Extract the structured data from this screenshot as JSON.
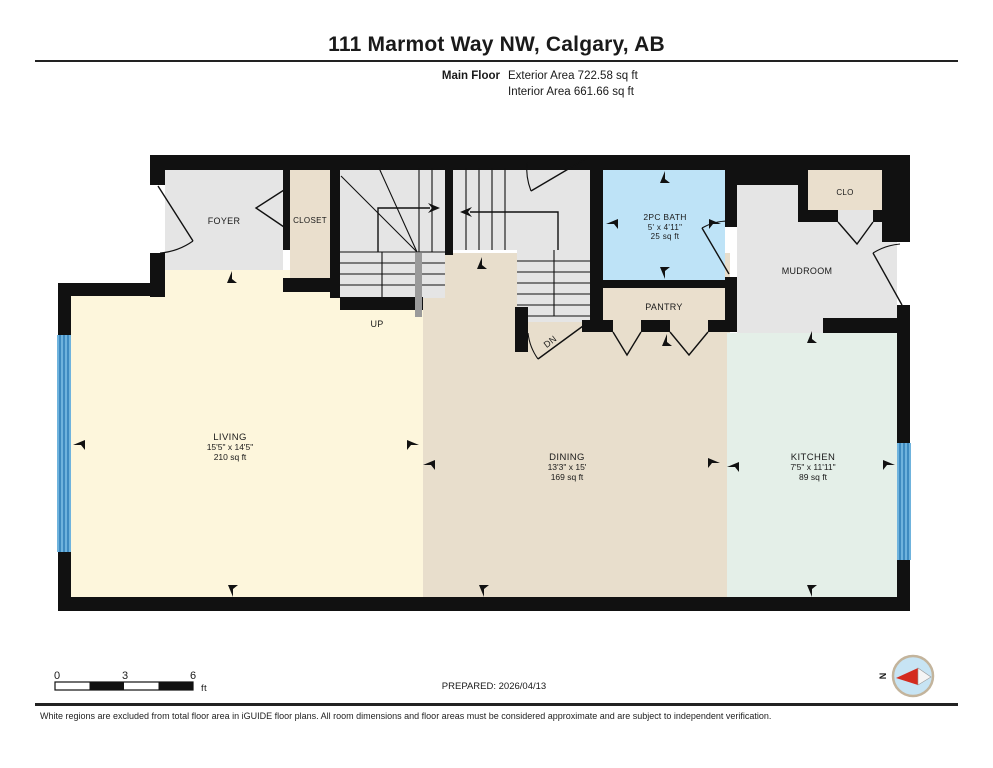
{
  "header": {
    "title": "111 Marmot Way NW, Calgary, AB",
    "floor_label": "Main Floor",
    "exterior_area": "Exterior Area 722.58 sq ft",
    "interior_area": "Interior Area 661.66 sq ft"
  },
  "rooms": {
    "foyer": {
      "name": "FOYER"
    },
    "closet": {
      "name": "CLOSET"
    },
    "bath": {
      "name": "2PC BATH",
      "dims": "5' x 4'11\"",
      "area": "25 sq ft"
    },
    "pantry": {
      "name": "PANTRY"
    },
    "mudroom": {
      "name": "MUDROOM"
    },
    "clo": {
      "name": "CLO"
    },
    "living": {
      "name": "LIVING",
      "dims": "15'5\" x 14'5\"",
      "area": "210 sq ft"
    },
    "dining": {
      "name": "DINING",
      "dims": "13'3\" x 15'",
      "area": "169 sq ft"
    },
    "kitchen": {
      "name": "KITCHEN",
      "dims": "7'5\" x 11'11\"",
      "area": "89 sq ft"
    }
  },
  "stairs": {
    "up": "UP",
    "dn": "DN"
  },
  "scale_bar": {
    "ticks": [
      "0",
      "3",
      "6"
    ],
    "unit": "ft"
  },
  "prepared_label": "PREPARED: 2026/04/13",
  "compass": {
    "north": "N"
  },
  "footer": {
    "disclaimer": "White regions are excluded from total floor area in iGUIDE floor plans. All room dimensions and floor areas must be considered approximate and are subject to independent verification."
  },
  "colors": {
    "wall": "#111111",
    "gray": "#e5e5e5",
    "beige": "#eadfcd",
    "dining": "#e8decc",
    "living": "#fdf6dc",
    "kitchen": "#e4efe8",
    "bath": "#bee3f7",
    "window": "#6fb3dd",
    "window_stripe": "#2a7ab5",
    "handrail": "#9a9a9a",
    "compass_ring": "#c3b49c",
    "compass_fill": "#c7e4f4",
    "compass_needle": "#d42b1e"
  }
}
